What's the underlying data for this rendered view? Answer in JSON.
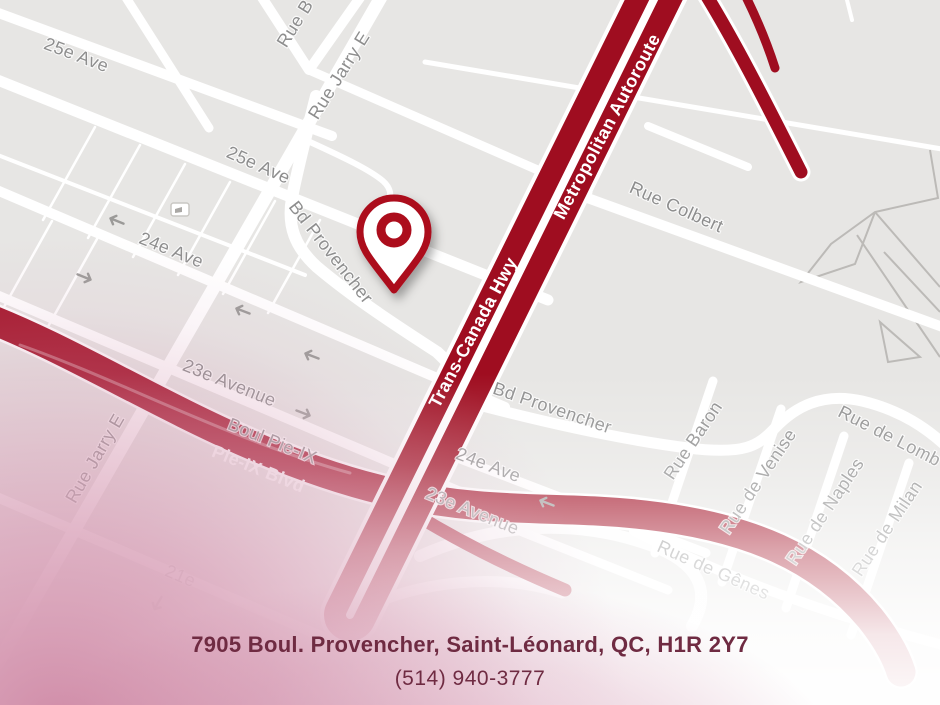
{
  "map": {
    "street_labels": [
      {
        "id": "25e-ave-upper",
        "text": "25e Ave"
      },
      {
        "id": "25e-ave-main",
        "text": "25e Ave"
      },
      {
        "id": "rue-b-partial",
        "text": "Rue B"
      },
      {
        "id": "rue-jarry-e-top",
        "text": "Rue Jarry E"
      },
      {
        "id": "bd-provencher-west",
        "text": "Bd Provencher"
      },
      {
        "id": "24e-ave-west",
        "text": "24e Ave"
      },
      {
        "id": "23e-avenue-west",
        "text": "23e Avenue"
      },
      {
        "id": "boul-pie-ix",
        "text": "Boul Pie-IX"
      },
      {
        "id": "rue-jarry-e-left",
        "text": "Rue Jarry E"
      },
      {
        "id": "21e-partial",
        "text": "21e"
      },
      {
        "id": "rue-colbert",
        "text": "Rue Colbert"
      },
      {
        "id": "bd-provencher-east",
        "text": "Bd Provencher"
      },
      {
        "id": "24e-ave-east",
        "text": "24e Ave"
      },
      {
        "id": "23e-avenue-east",
        "text": "23e Avenue"
      },
      {
        "id": "rue-baron",
        "text": "Rue Baron"
      },
      {
        "id": "rue-de-venise",
        "text": "Rue de Venise"
      },
      {
        "id": "rue-de-naples",
        "text": "Rue de Naples"
      },
      {
        "id": "rue-de-genes",
        "text": "Rue de Gênes"
      },
      {
        "id": "rue-de-milan",
        "text": "Rue de Milan"
      },
      {
        "id": "rue-de-lomb-partial",
        "text": "Rue de Lomb"
      }
    ],
    "highway_labels": [
      {
        "id": "trans-canada-hwy",
        "text": "Trans-Canada Hwy"
      },
      {
        "id": "metropolitan-autoroute",
        "text": "Metropolitan Autoroute"
      },
      {
        "id": "pie-ix-blvd",
        "text": "Pie-IX Blvd"
      }
    ],
    "pin": {
      "type": "location-pin"
    }
  },
  "footer": {
    "address": "7905 Boul. Provencher, Saint-Léonard, QC, H1R 2Y7",
    "phone": "(514) 940-3777"
  },
  "colors": {
    "map_background": "#e7e6e4",
    "road_white": "#ffffff",
    "highway_red": "#9f0d20",
    "pie_ix_red": "#a31126",
    "pin_red": "#ac0b1e",
    "street_label_gray": "#8e8e8e",
    "address_text": "#6f2b42"
  }
}
